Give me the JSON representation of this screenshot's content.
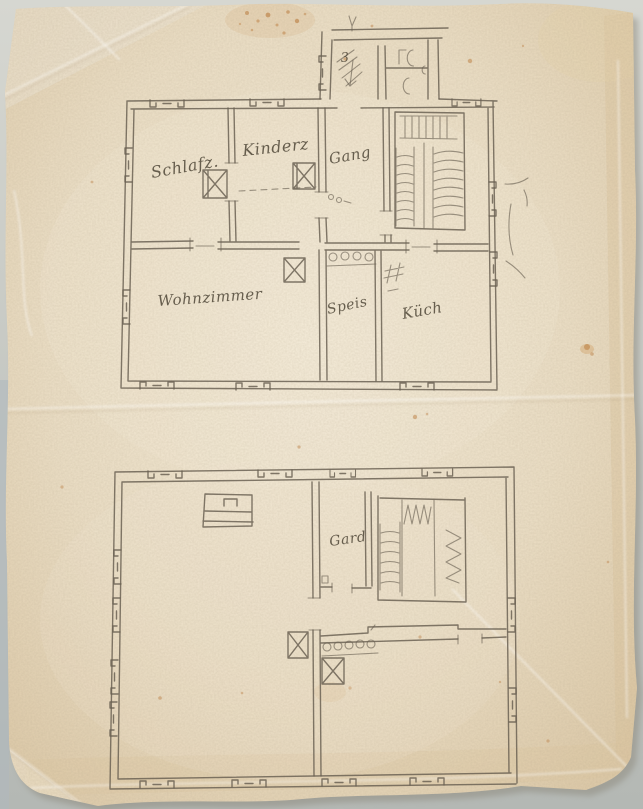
{
  "document": {
    "kind": "hand-drawn floor plan sketch, pencil on aged paper",
    "sheets_on_page": 2
  },
  "colors": {
    "paper": "#e8dcc4",
    "paper_edge": "#d9c6a4",
    "pencil": "#6b6254",
    "handwriting": "#4f4738",
    "foxing_spots": "#b97b3e",
    "scan_background": "#b9bcb6"
  },
  "plans": {
    "upper": {
      "name": "upper floor plan",
      "annex": {
        "stair_label": "3"
      },
      "rooms": {
        "schlafzimmer": {
          "label": "Schlafz."
        },
        "kinderzimmer": {
          "label": "Kinderz"
        },
        "gang": {
          "label": "Gang"
        },
        "wohnzimmer": {
          "label": "Wohnzimmer"
        },
        "speis": {
          "label": "Speis"
        },
        "kueche": {
          "label": "Küch"
        }
      },
      "symbols": [
        "stove-x-box",
        "stove-x-box",
        "stove-x-box",
        "hash-stove-mark",
        "column-circle-row",
        "stair-hatching",
        "up-arrow",
        "down-arrow",
        "wc-oval-marks",
        "entrance-curves",
        "dashed-partition",
        "window-symbols"
      ]
    },
    "lower": {
      "name": "ground floor plan",
      "rooms": {
        "gard": {
          "label": "Gard"
        }
      },
      "symbols": [
        "bed-outline",
        "stove-x-box",
        "stove-x-box",
        "column-circle-row",
        "stair-zigzag",
        "stair-hatching",
        "window-symbols"
      ]
    }
  }
}
